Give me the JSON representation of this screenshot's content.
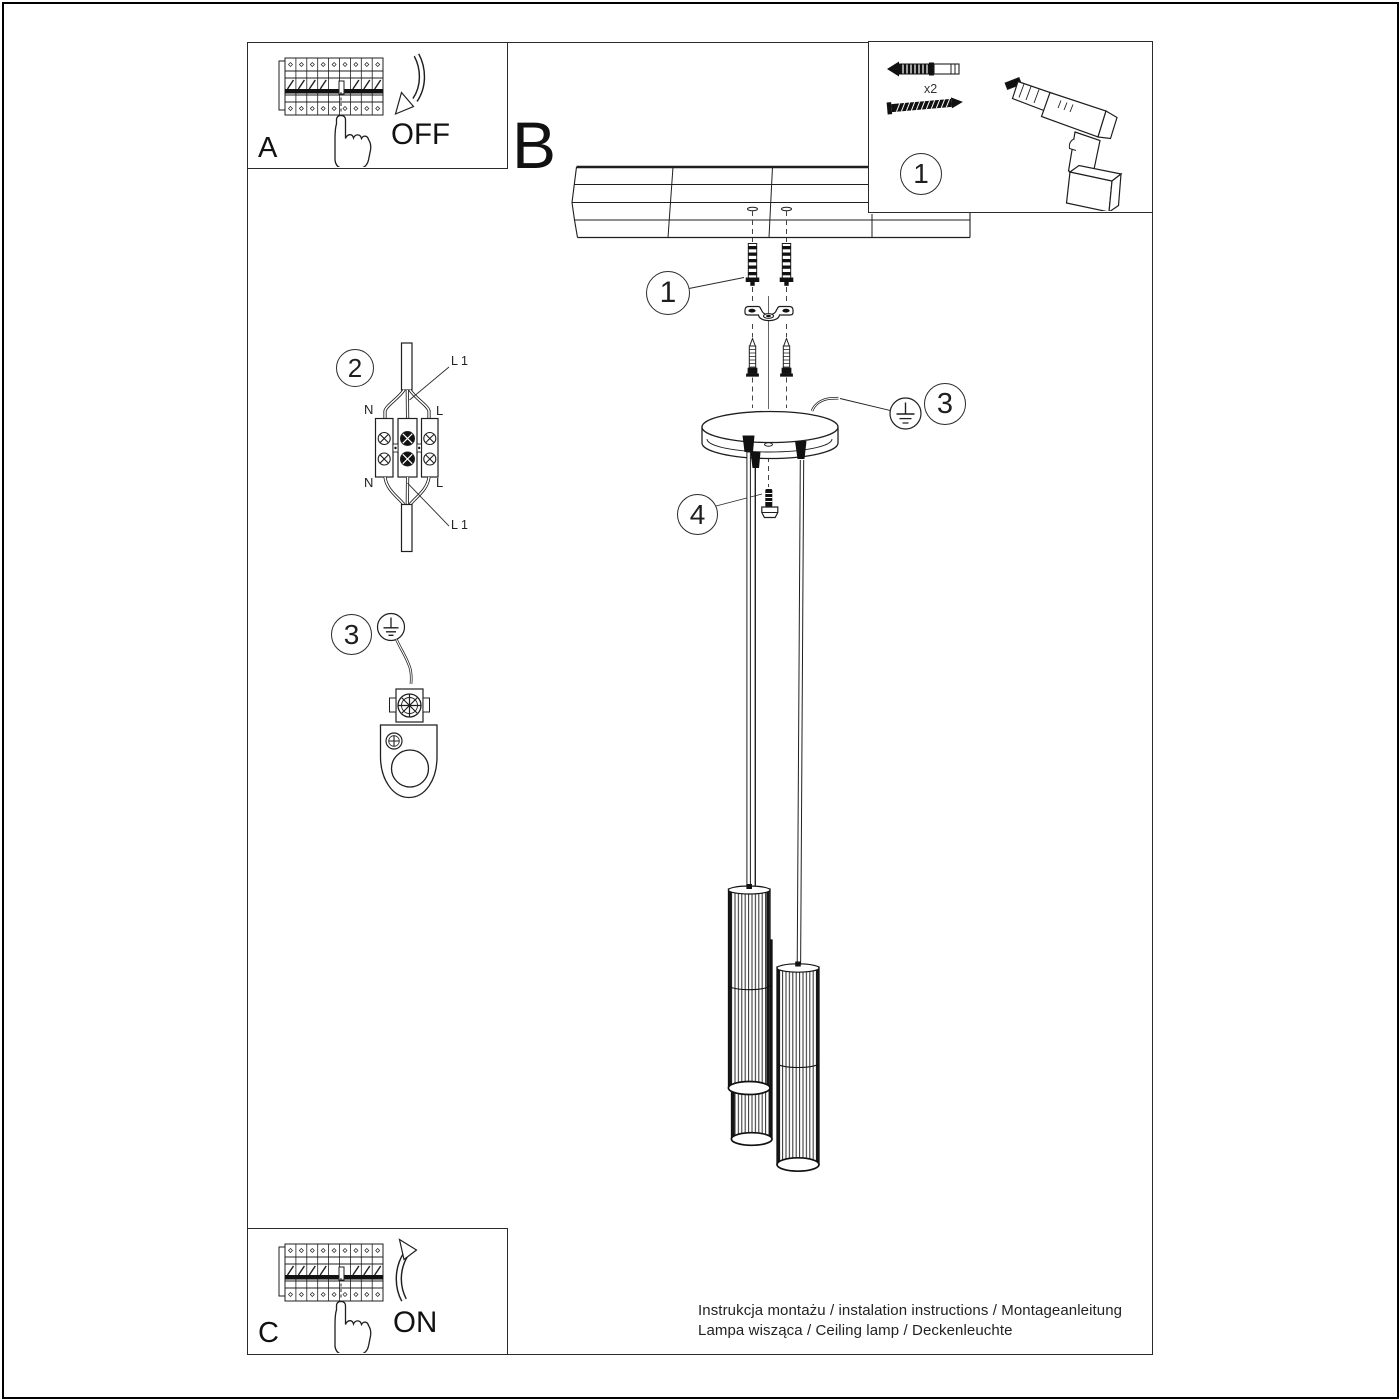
{
  "labels": {
    "panel_a": "A",
    "panel_b": "B",
    "panel_c": "C",
    "off": "OFF",
    "on": "ON",
    "quantity_x2": "x2"
  },
  "callouts": {
    "c1": "1",
    "c2": "2",
    "c3": "3",
    "c4": "4"
  },
  "wiring": {
    "n_top": "N",
    "l_top": "L",
    "n_bottom": "N",
    "l_bottom": "L",
    "l1_top": "L 1",
    "l1_bottom": "L 1"
  },
  "footer": {
    "line1": "Instrukcja montażu / instalation instructions / Montageanleitung",
    "line2": "Lampa wisząca / Ceiling lamp / Deckenleuchte"
  },
  "icons": {
    "breaker_panel": "circuit-breaker-row",
    "pointing_hand": "hand-index-finger",
    "curved_arrow_off": "arc-arrow-down",
    "curved_arrow_on": "arc-arrow-up",
    "wall_plug": "expansion-anchor",
    "screw": "wood-screw",
    "drill": "cordless-drill",
    "ground_symbol": "protective-earth",
    "ceiling": "wood-plank-ceiling",
    "canopy": "round-ceiling-canopy",
    "pendant": "fluted-tube-shade"
  },
  "colors": {
    "line": "#1f1f1f",
    "background": "#ffffff"
  }
}
